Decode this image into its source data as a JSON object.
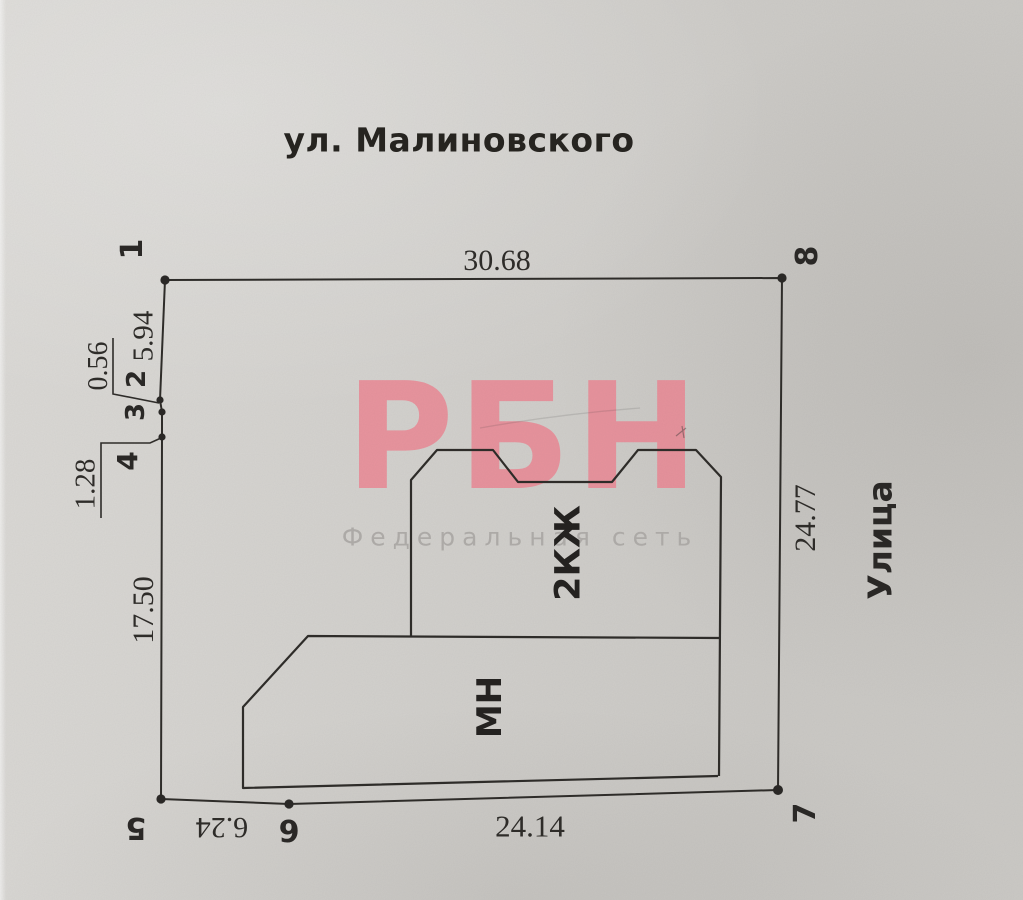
{
  "document": {
    "title": "ул. Малиновского",
    "street_label": "Улица"
  },
  "watermark": {
    "logo": "РБН",
    "tagline": "Федеральная сеть"
  },
  "buildings": {
    "main_house": "2КЖ",
    "annex": "МН"
  },
  "points": {
    "p1": "1",
    "p2": "2",
    "p3": "3",
    "p4": "4",
    "p5": "5",
    "p6": "6",
    "p7": "7",
    "p8": "8"
  },
  "dimensions": {
    "top": "30.68",
    "right": "24.77",
    "bottom": "24.14",
    "bottom_left": "6.24",
    "left_1_2": "5.94",
    "left_2_3": "0.56",
    "left_3_4": "1.28",
    "left_4_5": "17.50"
  },
  "colors": {
    "ink": "#2e2c29",
    "paper": "#d6d4d0",
    "watermark_pink": "#ee8290",
    "watermark_gray": "#aeaba8"
  }
}
